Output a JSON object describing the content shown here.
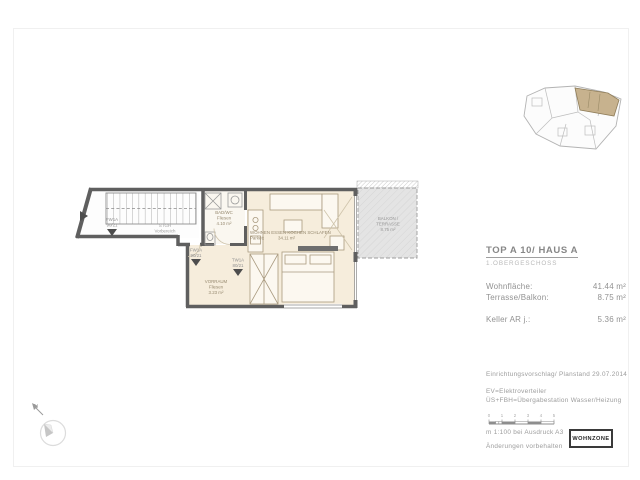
{
  "title_block": {
    "title": "TOP A 10/ HAUS A",
    "subtitle": "1.OBERGESCHOSS",
    "rows": [
      {
        "label": "Wohnfläche:",
        "value": "41.44 m²"
      },
      {
        "label": "Terrasse/Balkon:",
        "value": "8.75 m²"
      },
      {
        "label": "Keller AR j.:",
        "value": "5.36 m²"
      }
    ]
  },
  "floor_plan": {
    "rooms": {
      "stairs": {
        "name": "STGH",
        "sub": "Vorbereich"
      },
      "bath": {
        "name": "BAD/WC",
        "floor": "Fliesen",
        "area": "4.10 m²"
      },
      "hall": {
        "name": "VORRAUM",
        "floor": "Fliesen",
        "area": "3.23 m²"
      },
      "living": {
        "name": "WOHNEN ESSEN KOCHEN SCHLAFEN",
        "floor": "Parkett",
        "area": "34.11 m²"
      },
      "terrace": {
        "name": "BALKON /",
        "sub": "TERRASSE",
        "area": "8.75 m²"
      }
    },
    "doors": [
      {
        "code": "FW1A",
        "size": "90/21"
      },
      {
        "code": "FW1A",
        "size": "90/21"
      },
      {
        "code": "TW1A",
        "size": "80/21"
      }
    ],
    "colors": {
      "wall": "#5f5f5f",
      "floor": "#f6eddc",
      "terrace": "#e4e4e4",
      "common": "#fdfdfd",
      "highlight": "#c7b28e"
    }
  },
  "compass": {
    "north_label": "N"
  },
  "notes": {
    "plan_status": "Einrichtungsvorschlag/ Planstand 29.07.2014",
    "legend_ev": "EV=Elektroverteiler",
    "legend_uefbh": "ÜS+FBH=Übergabestation Wasser/Heizung",
    "scale_ticks": [
      "0",
      "1",
      "2",
      "3",
      "4",
      "5"
    ],
    "scale_note": "m 1:100 bei Ausdruck A3",
    "disclaimer": "Änderungen vorbehalten"
  },
  "logo": {
    "label": "WOHNZONE"
  }
}
